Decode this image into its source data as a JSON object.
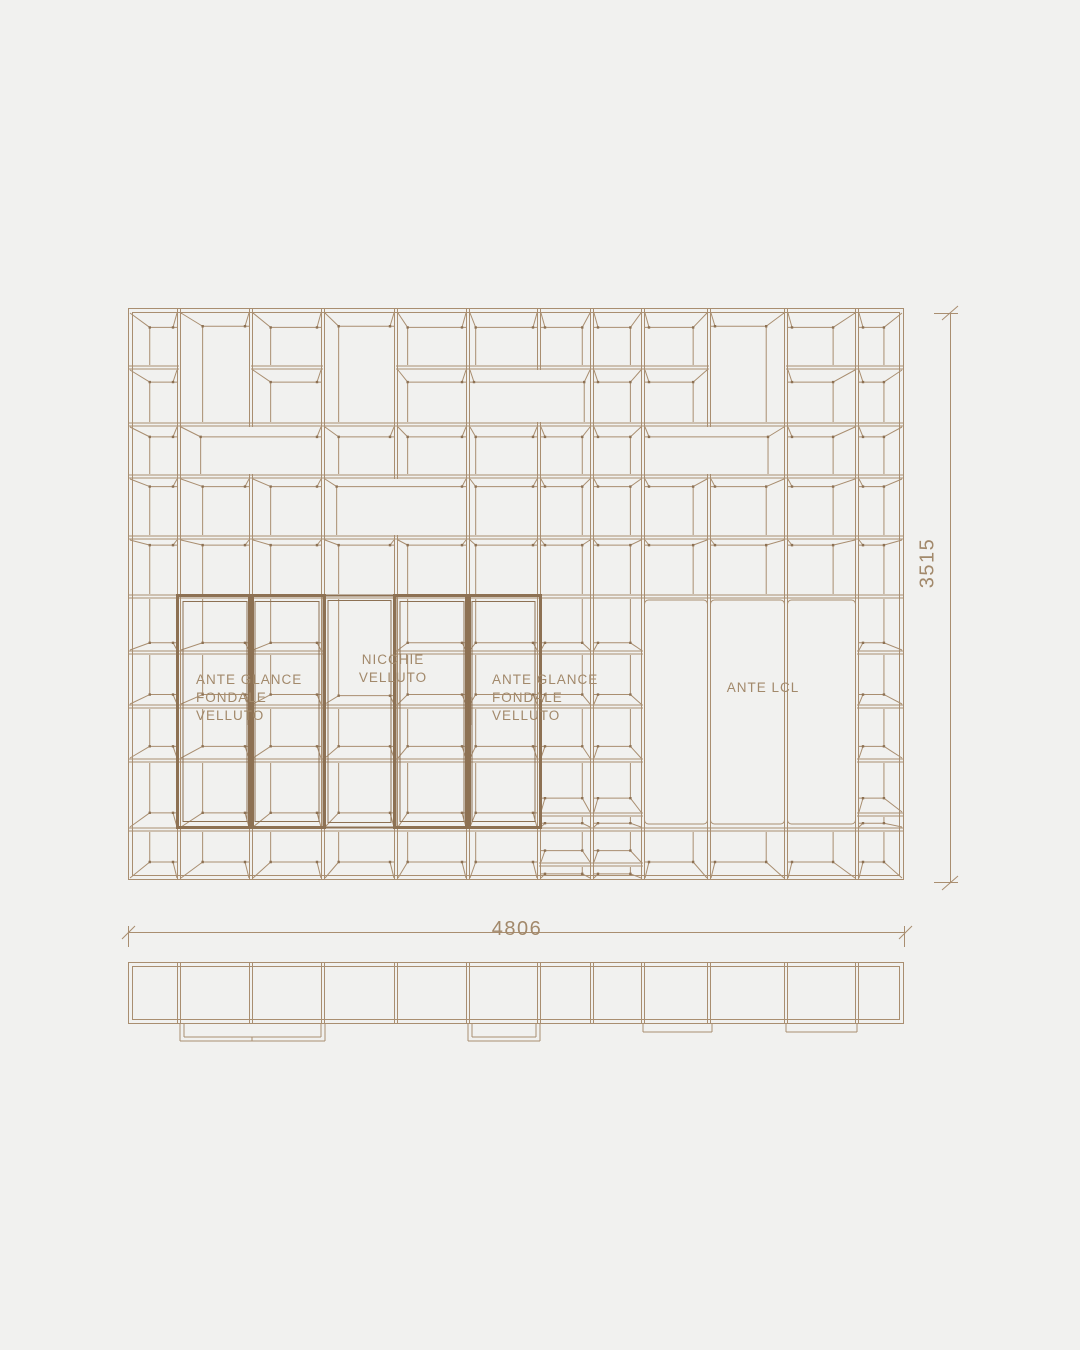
{
  "page": {
    "background": "#f1f1ef",
    "description": "technical elevation and plan drawing of shelving wall unit"
  },
  "drawing": {
    "colors": {
      "bg": "#f1f1ef",
      "line": "#a98e70",
      "frame": "#8d7153",
      "text": "#a2896b"
    },
    "elevation": {
      "x": [
        128,
        179,
        251,
        323,
        396,
        468,
        539,
        592,
        643,
        709,
        786,
        857,
        904
      ],
      "y": [
        308,
        366,
        423,
        475,
        536,
        595,
        651,
        705,
        759,
        813,
        828,
        863,
        880
      ],
      "vanish": {
        "x": 516,
        "eye": 570
      },
      "cells": [
        [
          [
            0,
            1
          ],
          [
            1,
            2
          ],
          [
            2,
            3
          ],
          [
            3,
            4
          ],
          [
            4,
            5
          ],
          [
            5,
            6
          ],
          [
            6,
            7
          ],
          [
            7,
            8
          ],
          [
            8,
            10
          ],
          [
            10,
            12
          ]
        ],
        [
          [
            0,
            2
          ],
          [
            3,
            4
          ],
          [
            4,
            5
          ],
          [
            5,
            6
          ],
          [
            6,
            7
          ],
          [
            7,
            8
          ],
          [
            8,
            10
          ],
          [
            10,
            12
          ]
        ],
        [
          [
            0,
            1
          ],
          [
            1,
            2
          ],
          [
            3,
            4
          ],
          [
            4,
            5
          ],
          [
            5,
            6
          ],
          [
            6,
            7
          ],
          [
            7,
            8
          ],
          [
            8,
            10
          ],
          [
            10,
            12
          ]
        ],
        [
          [
            0,
            2
          ],
          [
            2,
            3
          ],
          [
            4,
            5
          ],
          [
            5,
            7
          ],
          [
            7,
            8
          ],
          [
            8,
            10
          ],
          [
            10,
            12
          ]
        ],
        [
          [
            0,
            1
          ],
          [
            1,
            2
          ],
          [
            2,
            3
          ],
          [
            4,
            5
          ],
          [
            5,
            6
          ],
          [
            6,
            7
          ],
          [
            7,
            8
          ],
          [
            8,
            10
          ],
          [
            10,
            12
          ]
        ],
        [
          [
            0,
            1
          ],
          [
            2,
            3
          ],
          [
            3,
            4
          ],
          [
            4,
            5
          ],
          [
            5,
            6
          ],
          [
            6,
            7
          ],
          [
            7,
            8
          ],
          [
            8,
            10
          ],
          [
            10,
            12
          ]
        ],
        [
          [
            0,
            1
          ],
          [
            2,
            3
          ],
          [
            3,
            4
          ],
          [
            4,
            5
          ],
          [
            5,
            6
          ],
          [
            6,
            7
          ],
          [
            7,
            8
          ],
          [
            8,
            9
          ],
          [
            9,
            10
          ],
          [
            10,
            11
          ],
          [
            11,
            12
          ]
        ],
        [
          [
            0,
            1
          ],
          [
            1,
            2
          ],
          [
            2,
            3
          ],
          [
            3,
            4
          ],
          [
            4,
            5
          ],
          [
            5,
            6
          ],
          [
            6,
            7
          ],
          [
            7,
            8
          ],
          [
            8,
            9
          ],
          [
            9,
            10
          ],
          [
            10,
            11
          ],
          [
            11,
            12
          ]
        ],
        [
          [
            0,
            1
          ],
          [
            1,
            2
          ],
          [
            3,
            4
          ],
          [
            4,
            5
          ],
          [
            10,
            12
          ]
        ],
        [
          [
            0,
            2
          ],
          [
            3,
            4
          ],
          [
            4,
            5
          ],
          [
            10,
            12
          ]
        ],
        [
          [
            0,
            1
          ],
          [
            1,
            2
          ],
          [
            2,
            3
          ],
          [
            3,
            4
          ],
          [
            4,
            5
          ],
          [
            10,
            12
          ]
        ],
        [
          [
            0,
            1
          ],
          [
            1,
            2
          ],
          [
            2,
            3
          ],
          [
            3,
            4
          ],
          [
            4,
            5
          ],
          [
            5,
            6
          ],
          [
            6,
            7
          ],
          [
            7,
            8
          ],
          [
            8,
            9
          ],
          [
            9,
            10
          ],
          [
            10,
            12
          ]
        ]
      ],
      "wide": [
        [
          1,
          3,
          2,
          3
        ],
        [
          5,
          7,
          1,
          2
        ],
        [
          3,
          5,
          3,
          4
        ],
        [
          8,
          10,
          2,
          3
        ]
      ],
      "doors": [
        [
          1,
          2
        ],
        [
          2,
          3
        ],
        [
          4,
          5
        ],
        [
          5,
          6
        ]
      ],
      "niche": [
        3,
        4
      ],
      "door_y": [
        595,
        827
      ],
      "handles": [
        {
          "x": 249,
          "y": 697,
          "len": 28
        },
        {
          "x": 470,
          "y": 697,
          "len": 28
        }
      ],
      "panels": {
        "bounds": [
          [
            643,
            709
          ],
          [
            709,
            786
          ],
          [
            786,
            857
          ]
        ],
        "y": [
          600,
          824
        ]
      }
    },
    "plan": {
      "x": [
        128,
        904
      ],
      "y": [
        962,
        1024
      ],
      "dividers": [
        179,
        251,
        323,
        396,
        468,
        539,
        592,
        643,
        709,
        786,
        857
      ],
      "glass_doors": [
        {
          "x0": 180,
          "x1": 325,
          "tick": 252
        },
        {
          "x0": 468,
          "x1": 540,
          "tick": 0
        }
      ],
      "glass_depth": 17,
      "slab_doors": [
        [
          643,
          712
        ],
        [
          786,
          857
        ]
      ],
      "slab_depth": 8
    },
    "dimensions": {
      "width": {
        "value": "4806",
        "line_y": 932,
        "x0": 128,
        "x1": 905,
        "pos": {
          "x": 517,
          "y": 918,
          "anchor": "top-center"
        }
      },
      "height": {
        "value": "3515",
        "line_x": 950,
        "y0": 313,
        "y1": 883,
        "pos": {
          "x": 928,
          "y": 563,
          "anchor": "center-rot"
        }
      }
    },
    "labels": {
      "door_left": {
        "text": "ANTE GLANCE\nFONDALE\nVELLUTO",
        "pos": {
          "x": 196,
          "y": 671,
          "anchor": "left"
        }
      },
      "niche": {
        "text": "NICCHIE\nVELLUTO",
        "pos": {
          "x": 393,
          "y": 651,
          "anchor": "top-center"
        }
      },
      "door_right": {
        "text": "ANTE GLANCE\nFONDALE\nVELLUTO",
        "pos": {
          "x": 492,
          "y": 671,
          "anchor": "left"
        }
      },
      "ante_lcl": {
        "text": "ANTE LCL",
        "pos": {
          "x": 763,
          "y": 679,
          "anchor": "top-center"
        }
      }
    }
  }
}
